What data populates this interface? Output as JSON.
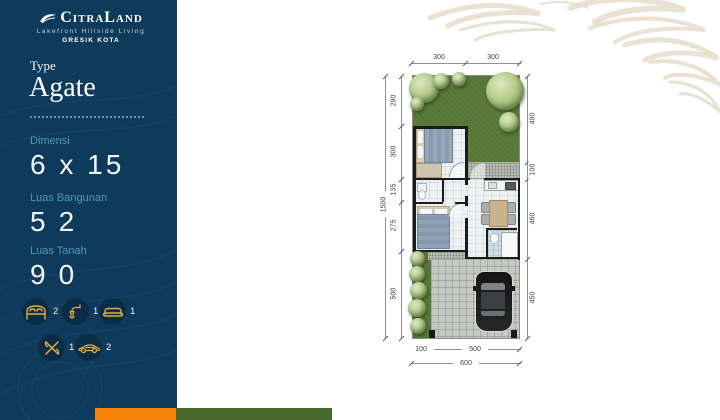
{
  "brand": {
    "name": "CitraLand",
    "tagline": "Lakefront Hillside Living",
    "city": "GRESIK KOTA"
  },
  "unit": {
    "type_label": "Type",
    "type_name": "Agate"
  },
  "specs": [
    {
      "label": "Dimensi",
      "value": "6 x 15"
    },
    {
      "label": "Luas Bangunan",
      "value": "52"
    },
    {
      "label": "Luas Tanah",
      "value": "90"
    }
  ],
  "features": [
    {
      "icon": "bed-icon",
      "count": "2"
    },
    {
      "icon": "shower-icon",
      "count": "1"
    },
    {
      "icon": "sofa-icon",
      "count": "1"
    },
    {
      "icon": "cutlery-icon",
      "count": "1"
    },
    {
      "icon": "car-icon",
      "count": "2"
    }
  ],
  "plan": {
    "dims": {
      "top": [
        "300",
        "300"
      ],
      "left_total": "1500",
      "left": [
        "290",
        "300",
        "135",
        "275",
        "500"
      ],
      "right": [
        "490",
        "100",
        "460",
        "450"
      ],
      "bottom": [
        "100",
        "500"
      ],
      "bottom_total": "600"
    }
  },
  "colors": {
    "navy": "#0e3a5b",
    "teal": "#4d9cb9",
    "gold": "#dfaf3f",
    "orange_bar": "#f8820a",
    "green_bar": "#47682c",
    "garden_green": "#567737"
  }
}
